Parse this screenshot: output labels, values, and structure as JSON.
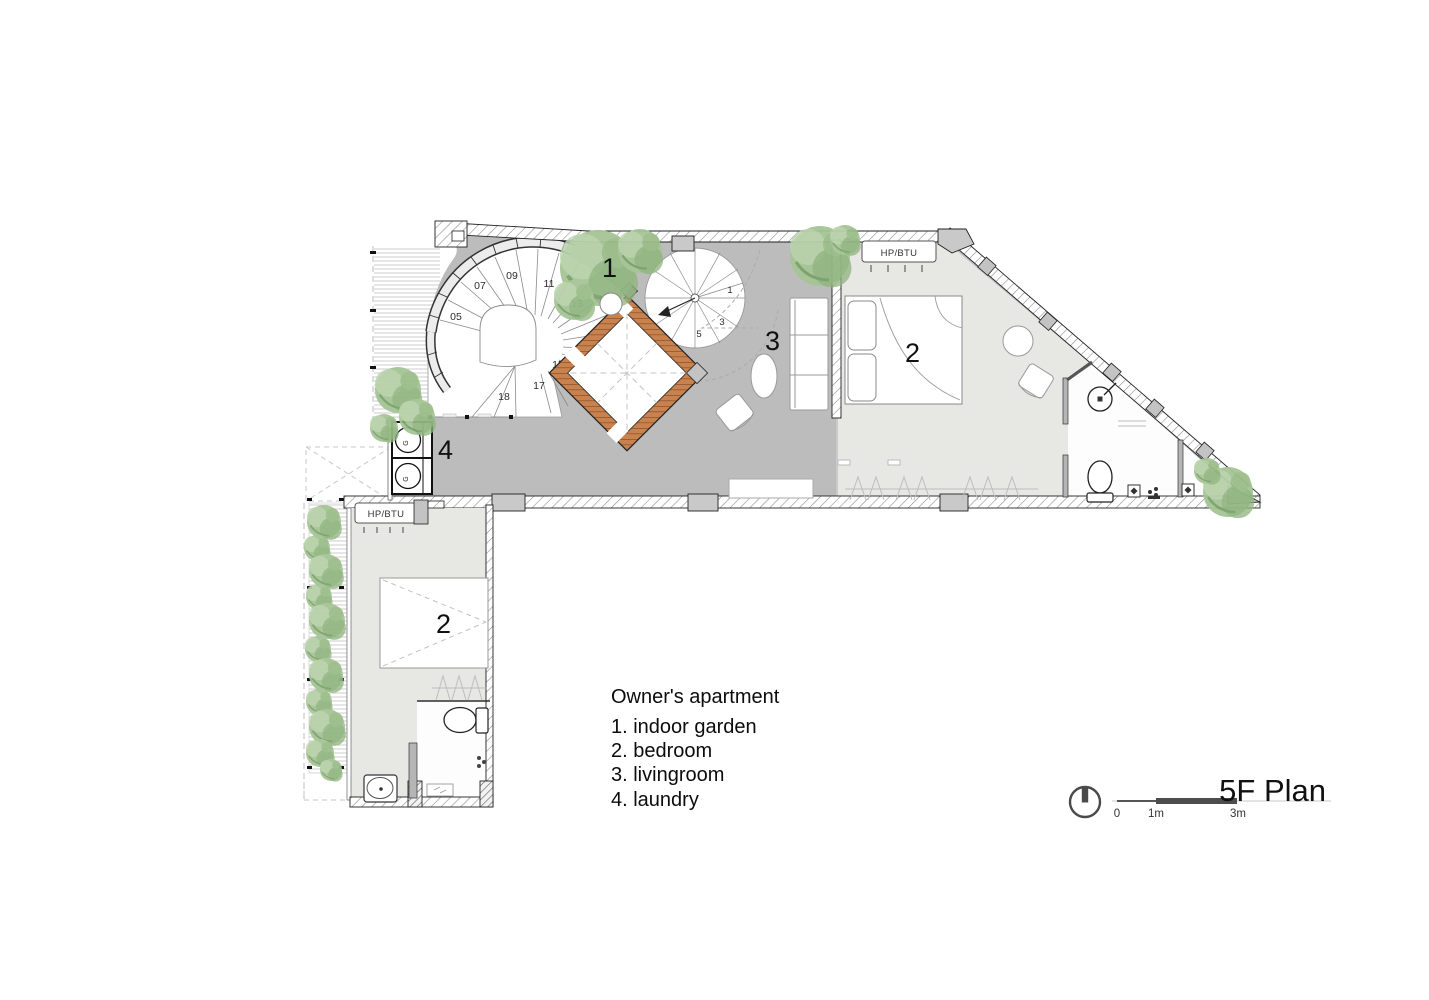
{
  "plan": {
    "title": "5F Plan"
  },
  "legend": {
    "title": "Owner's apartment",
    "items": [
      "1. indoor garden",
      "2. bedroom",
      "3. livingroom",
      "4. laundry"
    ]
  },
  "scale": {
    "zero": "0",
    "one": "1m",
    "three": "3m"
  },
  "rooms": {
    "indoor_garden": "1",
    "livingroom": "3",
    "bedroom_upper": "2",
    "bedroom_lower": "2",
    "laundry": "4"
  },
  "stairs": {
    "main_steps": [
      "05",
      "07",
      "09",
      "11",
      "13",
      "15",
      "17",
      "18"
    ],
    "small_steps": [
      "1",
      "3",
      "5"
    ]
  },
  "equipment": {
    "hp_btu": "HP/BTU",
    "washer": "G"
  },
  "colors": {
    "floor_main": "#bcbcbc",
    "floor_light": "#e7e7e4",
    "wall_accent": "#c9824e",
    "tree": "#a6c497"
  }
}
